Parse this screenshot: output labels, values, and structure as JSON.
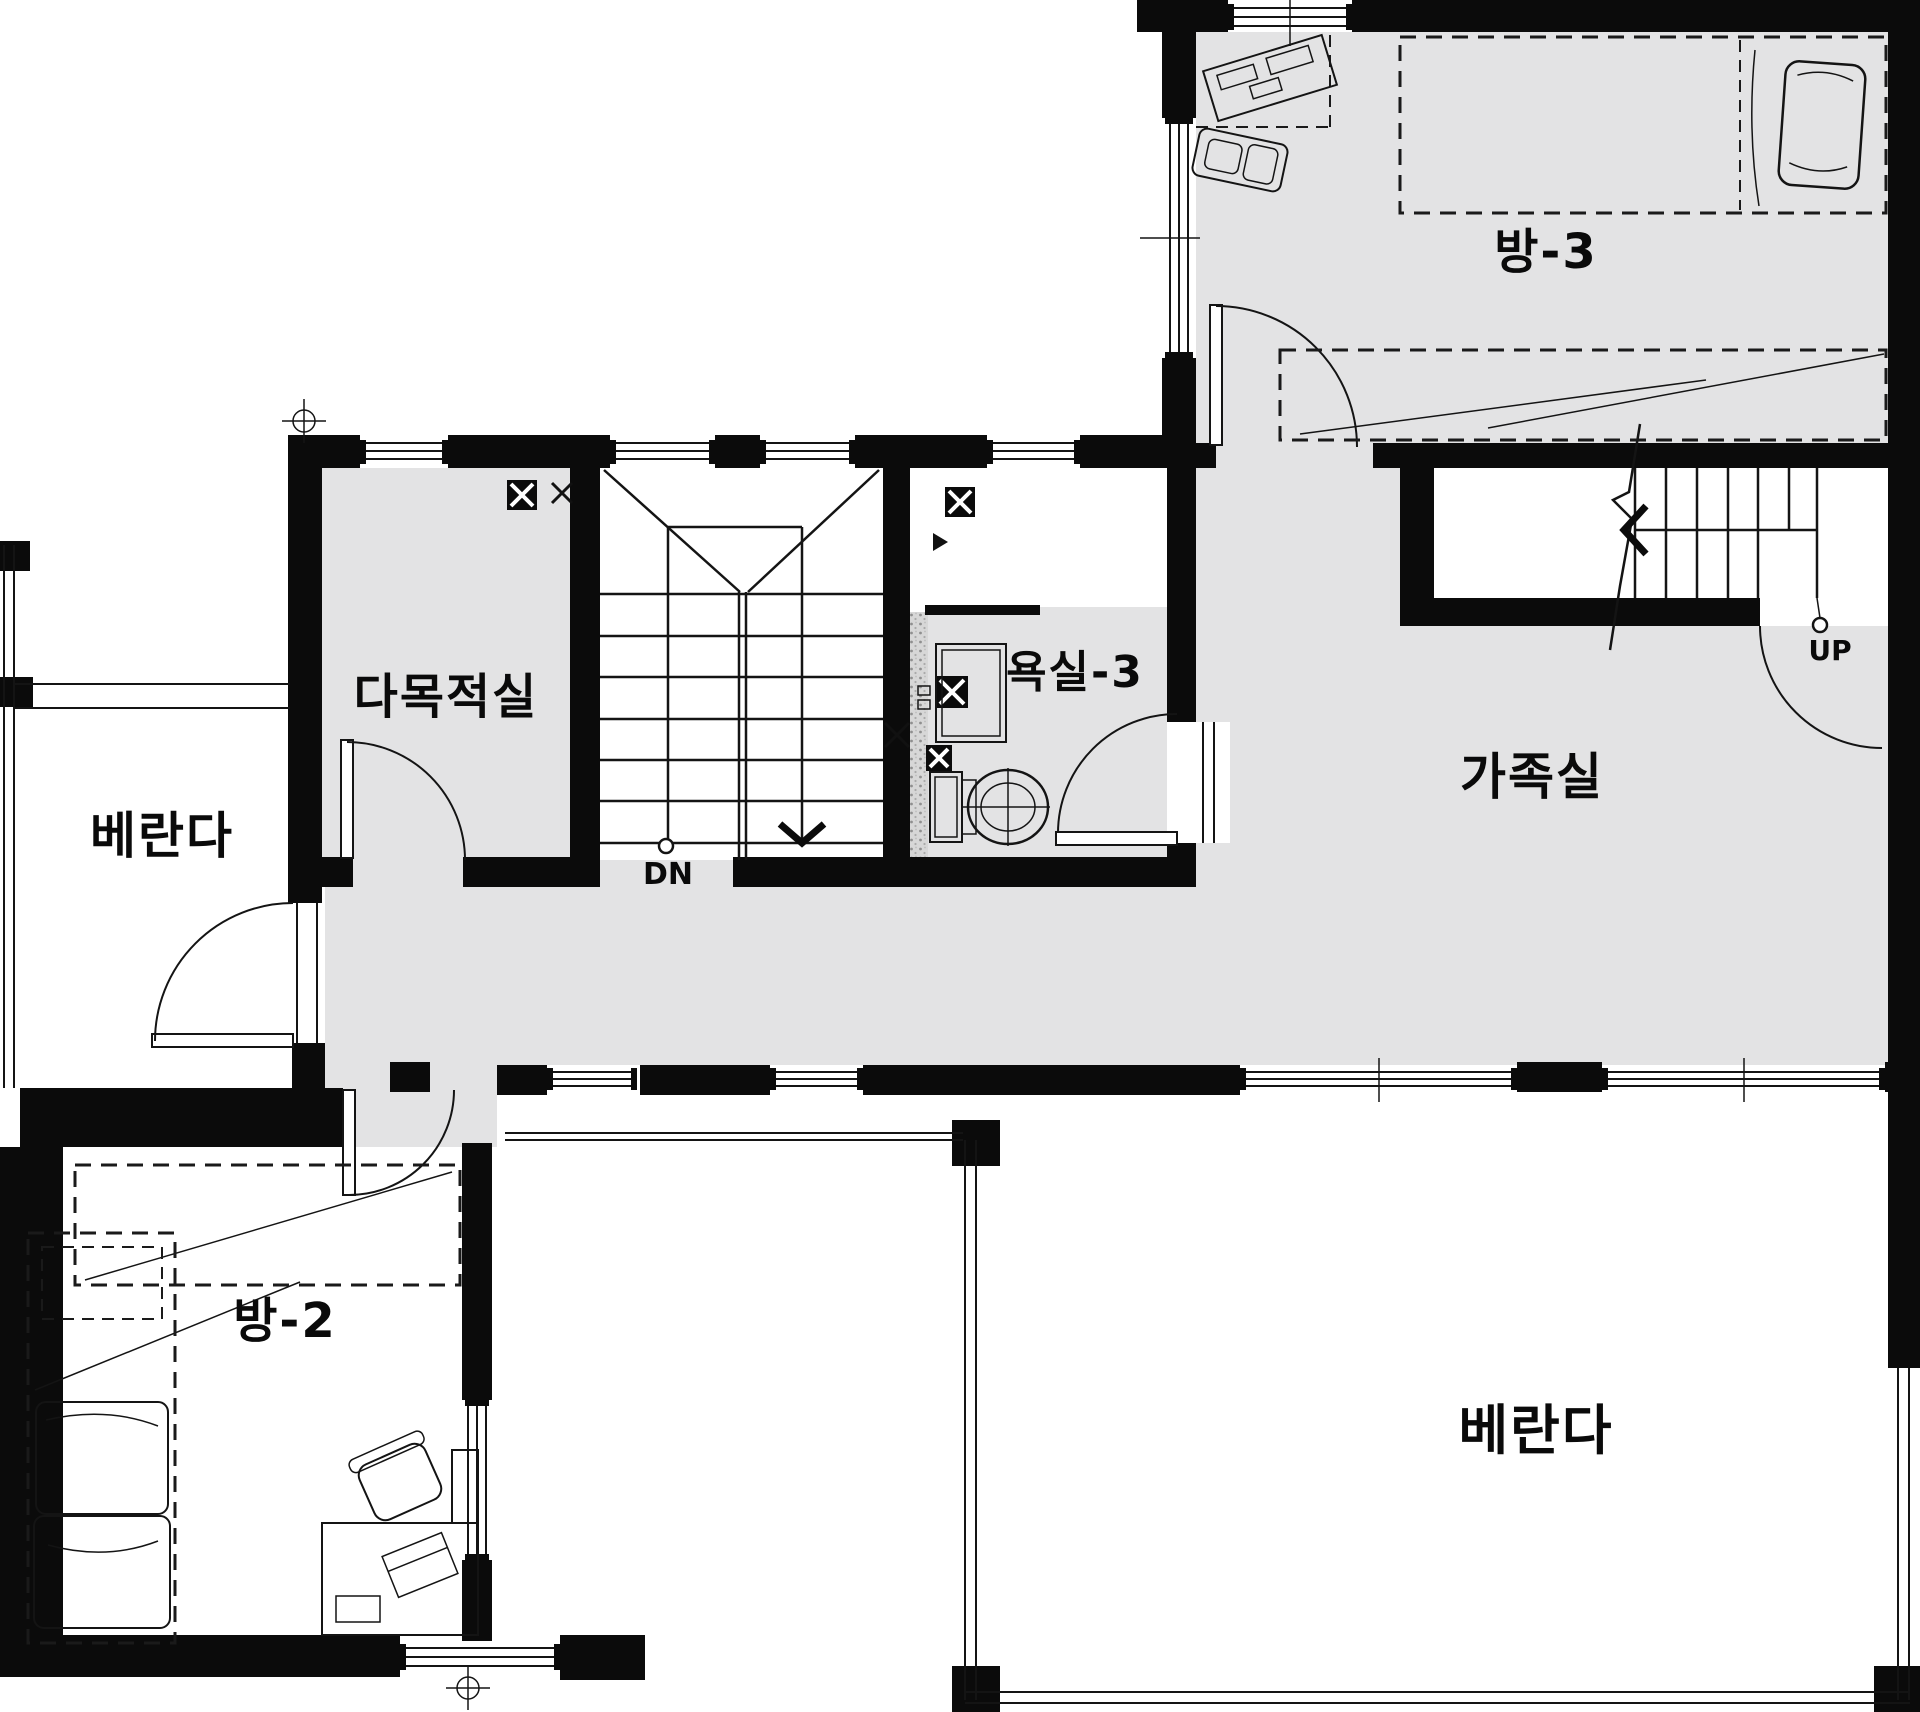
{
  "drawing": {
    "type": "floor-plan",
    "rooms": {
      "room3": {
        "label": "방-3"
      },
      "multipurpose": {
        "label": "다목적실"
      },
      "bath3": {
        "label": "욕실-3"
      },
      "family": {
        "label": "가족실"
      },
      "veranda_left": {
        "label": "베란다"
      },
      "room2": {
        "label": "방-2"
      },
      "veranda_bottom": {
        "label": "베란다"
      }
    },
    "stairs": {
      "down": "DN",
      "up": "UP"
    },
    "colors": {
      "floor": "#e3e3e4",
      "wall": "#0b0b0b",
      "line": "#141414",
      "background": "#ffffff",
      "tile_speckle": "#9a9a9a"
    }
  }
}
